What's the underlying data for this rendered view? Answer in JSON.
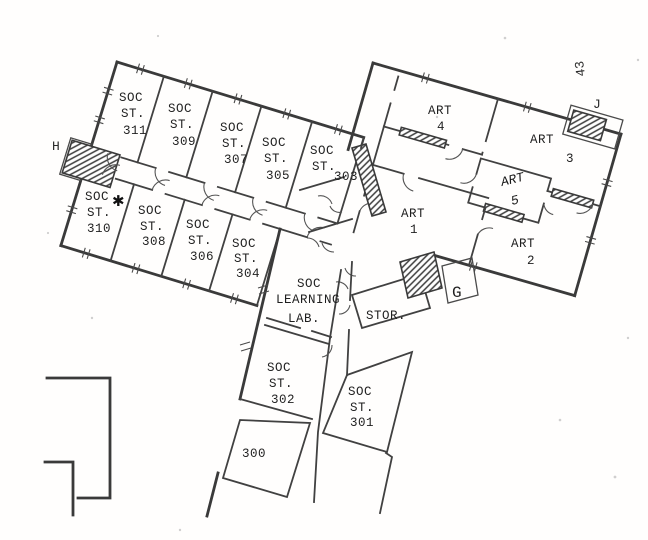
{
  "labels": {
    "soc311": [
      "SOC",
      "ST.",
      "311"
    ],
    "soc309": [
      "SOC",
      "ST.",
      "309"
    ],
    "soc307": [
      "SOC",
      "ST.",
      "307"
    ],
    "soc305": [
      "SOC",
      "ST.",
      "305"
    ],
    "soc303": [
      "SOC",
      "ST.",
      "303"
    ],
    "soc310": [
      "SOC",
      "ST.",
      "310"
    ],
    "soc308": [
      "SOC",
      "ST.",
      "308"
    ],
    "soc306": [
      "SOC",
      "ST.",
      "306"
    ],
    "soc304": [
      "SOC",
      "ST.",
      "304"
    ],
    "learning_lab": [
      "SOC",
      "LEARNING",
      "LAB."
    ],
    "stor": [
      "STOR."
    ],
    "soc302": [
      "SOC",
      "ST.",
      "302"
    ],
    "soc301": [
      "SOC",
      "ST.",
      "301"
    ],
    "r300": [
      "300"
    ],
    "art4": [
      "ART",
      "4"
    ],
    "art3": [
      "ART",
      "3"
    ],
    "art5": [
      "ART",
      "5"
    ],
    "art1": [
      "ART",
      "1"
    ],
    "art2": [
      "ART",
      "2"
    ]
  },
  "markers": {
    "h": "H",
    "g": "G",
    "j": "J",
    "n43": "43",
    "star": "✱"
  }
}
